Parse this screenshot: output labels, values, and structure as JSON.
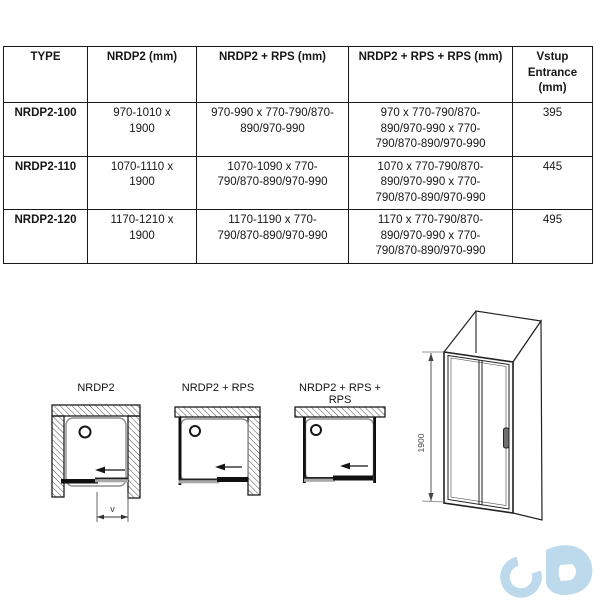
{
  "table": {
    "headers": [
      "TYPE",
      "NRDP2 (mm)",
      "NRDP2 + RPS (mm)",
      "NRDP2 + RPS + RPS (mm)",
      "Vstup\nEntrance\n(mm)"
    ],
    "rows": [
      [
        "NRDP2-100",
        "970-1010 x 1900",
        "970-990 x 770-790/870-890/970-990",
        "970 x 770-790/870-890/970-990 x 770-790/870-890/970-990",
        "395"
      ],
      [
        "NRDP2-110",
        "1070-1110 x 1900",
        "1070-1090 x 770-790/870-890/970-990",
        "1070 x 770-790/870-890/970-990 x 770-790/870-890/970-990",
        "445"
      ],
      [
        "NRDP2-120",
        "1170-1210 x 1900",
        "1170-1190 x 770-790/870-890/970-990",
        "1170 x 770-790/870-890/970-990 x 770-790/870-890/970-990",
        "495"
      ]
    ]
  },
  "diagrams": {
    "plan_labels": [
      "NRDP2",
      "NRDP2 + RPS",
      "NRDP2 + RPS + RPS"
    ],
    "entrance_dim_label": "v",
    "elevation_height_label": "1900"
  },
  "logo": {
    "glyph": "cd-infinity-watermark",
    "color": "#bdd9ec"
  }
}
